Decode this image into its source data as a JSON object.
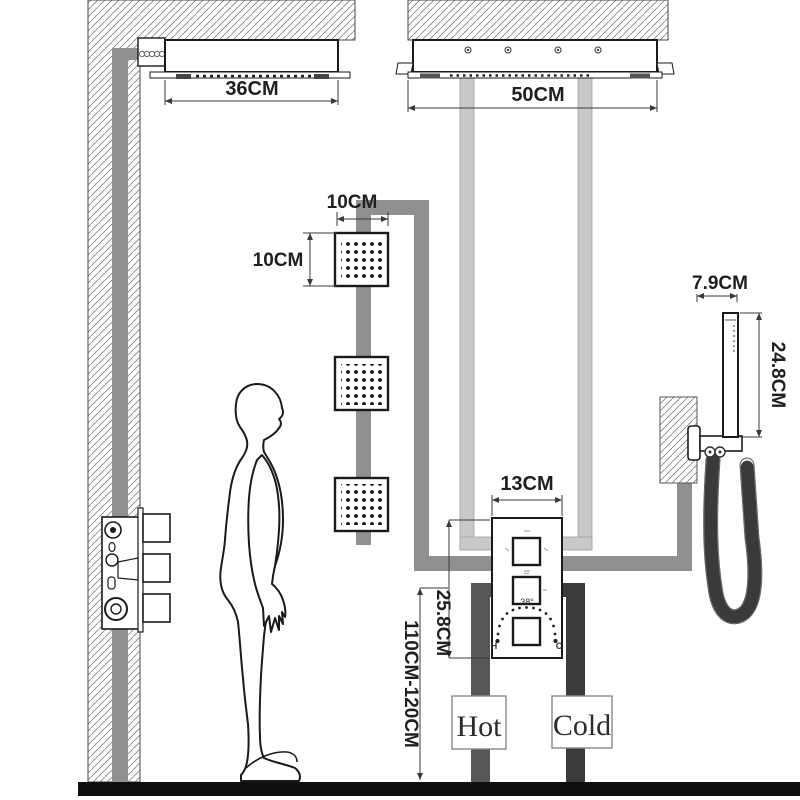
{
  "diagram": {
    "type": "shower-system-installation-diagram",
    "units": "CM",
    "labels": {
      "rain_head_width": "36CM",
      "ceiling_head_width": "50CM",
      "body_jet_width": "10CM",
      "body_jet_height": "10CM",
      "hand_shower_width": "7.9CM",
      "hand_shower_height": "24.8CM",
      "valve_width": "13CM",
      "valve_height": "25.8CM",
      "install_height": "110CM-120CM",
      "hot": "Hot",
      "cold": "Cold",
      "temperature": "38°",
      "hot_abbr": "H",
      "cold_abbr": "C"
    },
    "colors": {
      "outline": "#1a1a1a",
      "pipe_light": "#c9c9c9",
      "pipe_medium": "#909090",
      "pipe_hot": "#575757",
      "pipe_cold": "#3b3b3b",
      "pipe_dark_bridge": "#4a4a4a",
      "floor": "#0f0f0f",
      "dim_line": "#3a3a3a"
    }
  }
}
